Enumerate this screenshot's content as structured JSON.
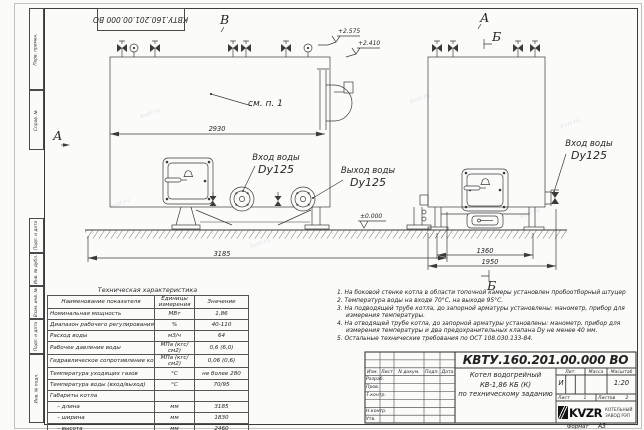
{
  "watermark": "kvzr.ru",
  "stamp_top": {
    "doc_number_rotated": "КВТУ.160.201.00.000 ВО"
  },
  "margin_labels": [
    "Перв. примен.",
    "Справ. №",
    "Подп. и дата",
    "Инв. № дубл.",
    "Взам. инв. №",
    "Подп. и дата",
    "Инв. № подл."
  ],
  "drawing": {
    "markers": {
      "v": "В",
      "a_side": "А",
      "a_top": "А",
      "b_top": "Б",
      "b_bottom": "Б"
    },
    "see_note": "см. п. 1",
    "labels": {
      "inlet_left_1": "Вход воды",
      "inlet_left_2": "Dy125",
      "outlet_1": "Выход воды",
      "outlet_2": "Dy125",
      "inlet_right_1": "Вход воды",
      "inlet_right_2": "Dy125"
    },
    "elevations": {
      "e1": "+2.575",
      "e2": "+2.410",
      "e0": "±0.000"
    },
    "dims": {
      "d2930": "2930",
      "d3185": "3185",
      "d1360": "1360",
      "d1950": "1950"
    }
  },
  "spec_table": {
    "title": "Техническая характеристика",
    "headers": [
      "Наименование показателя",
      "Единицы измерения",
      "Значение"
    ],
    "rows": [
      [
        "Номинальная мощность",
        "МВт",
        "1,86"
      ],
      [
        "Диапазон рабочего регулирования",
        "%",
        "40-110"
      ],
      [
        "Расход воды",
        "м3/ч",
        "64"
      ],
      [
        "Рабочее давление воды",
        "МПа (кгс/см2)",
        "0,6 (6,0)"
      ],
      [
        "Гидравлическое сопротивление котла",
        "МПа (кгс/см2)",
        "0,06 (0,6)"
      ],
      [
        "Температура уходящих газов",
        "°С",
        "не более 280"
      ],
      [
        "Температура воды (вход/выход)",
        "°С",
        "70/95"
      ],
      [
        "Габариты котла",
        "",
        ""
      ],
      [
        "    – длина",
        "мм",
        "3185"
      ],
      [
        "    – ширина",
        "мм",
        "1830"
      ],
      [
        "    – высота",
        "мм",
        "2460"
      ]
    ]
  },
  "notes": [
    "1.  На боковой стенке котла в области топочной камеры установлен пробоотборный штуцер",
    "2.  Температура воды на входе 70°С, на выходе 95°С.",
    "3.  На подводящей трубе котла, до запорной арматуры установлены: манометр, прибор для измерения температуры.",
    "4.  На отводящей трубе котла, до запорной арматуры установлены: манометр, прибор для измерения температуры и два предохранительных клапана Dу не менее 40 мм.",
    "5.  Остальные технические требования по ОСТ 108.030.133-84."
  ],
  "title_block": {
    "doc_number": "КВТУ.160.201.00.000  ВО",
    "name_line1": "Котел водогрейный",
    "name_line2": "КВ-1,86 КБ (К)",
    "name_line3": "по техническому заданию",
    "header_cells": [
      "Изм.",
      "Лист",
      "N докум.",
      "Подп.",
      "Дата"
    ],
    "row_labels": [
      "Разраб.",
      "Пров.",
      "Т.контр.",
      "",
      "Н.контр.",
      "Утв."
    ],
    "lit_label": "Лит.",
    "lit_value": "И",
    "mass_label": "Масса",
    "scale_label": "Масштаб",
    "scale_value": "1:20",
    "sheet_label": "Лист",
    "sheet_value": "1",
    "sheets_label": "Листов",
    "sheets_value": "2",
    "company": "KVZR",
    "company_sub1": "КОТЕЛЬНЫЙ",
    "company_sub2": "ЗАВОД РЭП",
    "format_label": "Формат",
    "format_value": "А3"
  }
}
